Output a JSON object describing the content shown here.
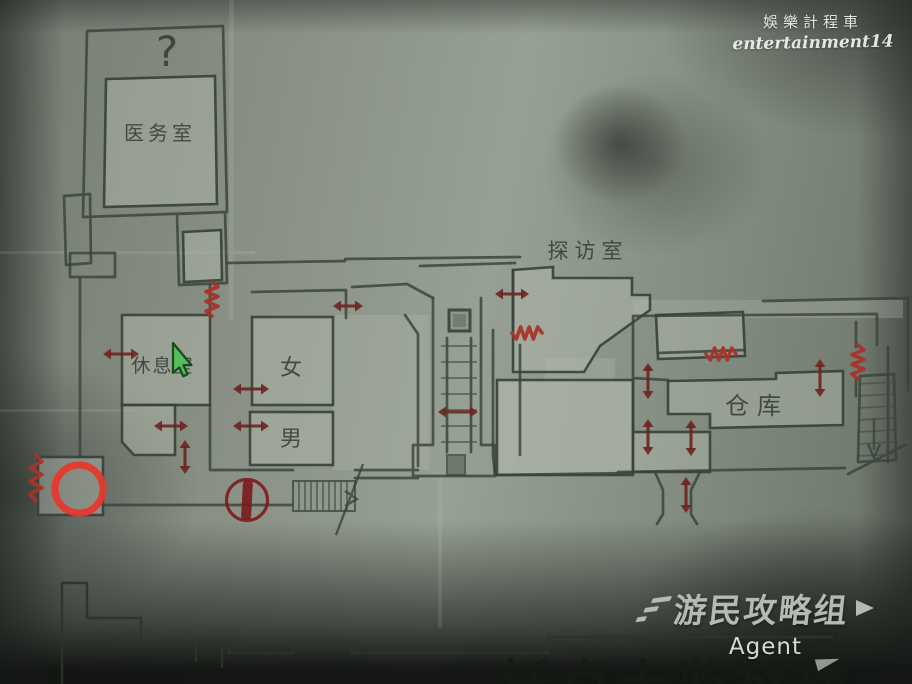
{
  "map": {
    "title": "托卢卡监狱楼",
    "rooms": {
      "infirmary": "医务室",
      "unknown_mark": "?",
      "rest_room": "休息室",
      "toilet_female": "女",
      "toilet_male": "男",
      "visiting_room": "探访室",
      "warehouse": "仓库"
    },
    "colors": {
      "pencil": "#39423a",
      "arrow": "#6e2420",
      "zigzag": "#a8332a",
      "highlight_ring": "#e6382c",
      "circled_bar_marker": "#7d1c1c",
      "cursor_green": "#57bd5c"
    },
    "symbols": {
      "door_arrows": [
        {
          "x": 121,
          "y": 354,
          "dir": "h",
          "len": 36
        },
        {
          "x": 171,
          "y": 426,
          "dir": "h",
          "len": 34
        },
        {
          "x": 185,
          "y": 457,
          "dir": "v",
          "len": 34
        },
        {
          "x": 251,
          "y": 389,
          "dir": "h",
          "len": 36
        },
        {
          "x": 251,
          "y": 426,
          "dir": "h",
          "len": 36
        },
        {
          "x": 348,
          "y": 306,
          "dir": "h",
          "len": 30
        },
        {
          "x": 458,
          "y": 412,
          "dir": "h",
          "len": 40
        },
        {
          "x": 512,
          "y": 294,
          "dir": "h",
          "len": 34
        },
        {
          "x": 648,
          "y": 381,
          "dir": "v",
          "len": 36
        },
        {
          "x": 820,
          "y": 378,
          "dir": "v",
          "len": 38
        },
        {
          "x": 648,
          "y": 437,
          "dir": "v",
          "len": 36
        },
        {
          "x": 691,
          "y": 438,
          "dir": "v",
          "len": 36
        },
        {
          "x": 686,
          "y": 495,
          "dir": "v",
          "len": 36
        }
      ],
      "blocked_zigzags": [
        {
          "x": 212,
          "y": 299,
          "dir": "v",
          "len": 34
        },
        {
          "x": 527,
          "y": 333,
          "dir": "h",
          "len": 30
        },
        {
          "x": 721,
          "y": 354,
          "dir": "h",
          "len": 30
        },
        {
          "x": 858,
          "y": 362,
          "dir": "v",
          "len": 34
        },
        {
          "x": 36,
          "y": 478,
          "dir": "v",
          "len": 46
        }
      ],
      "highlight_ring": {
        "x": 79,
        "y": 489,
        "r": 24
      },
      "circled_bar_marker": {
        "x": 247,
        "y": 500,
        "r": 20.5
      },
      "cursor": {
        "x": 173,
        "y": 343
      }
    }
  },
  "watermarks": {
    "top": {
      "line1": "娛樂計程車",
      "line2": "entertainment14"
    },
    "bottom": {
      "logo": "游民攻略组",
      "sub": "Agent"
    }
  }
}
